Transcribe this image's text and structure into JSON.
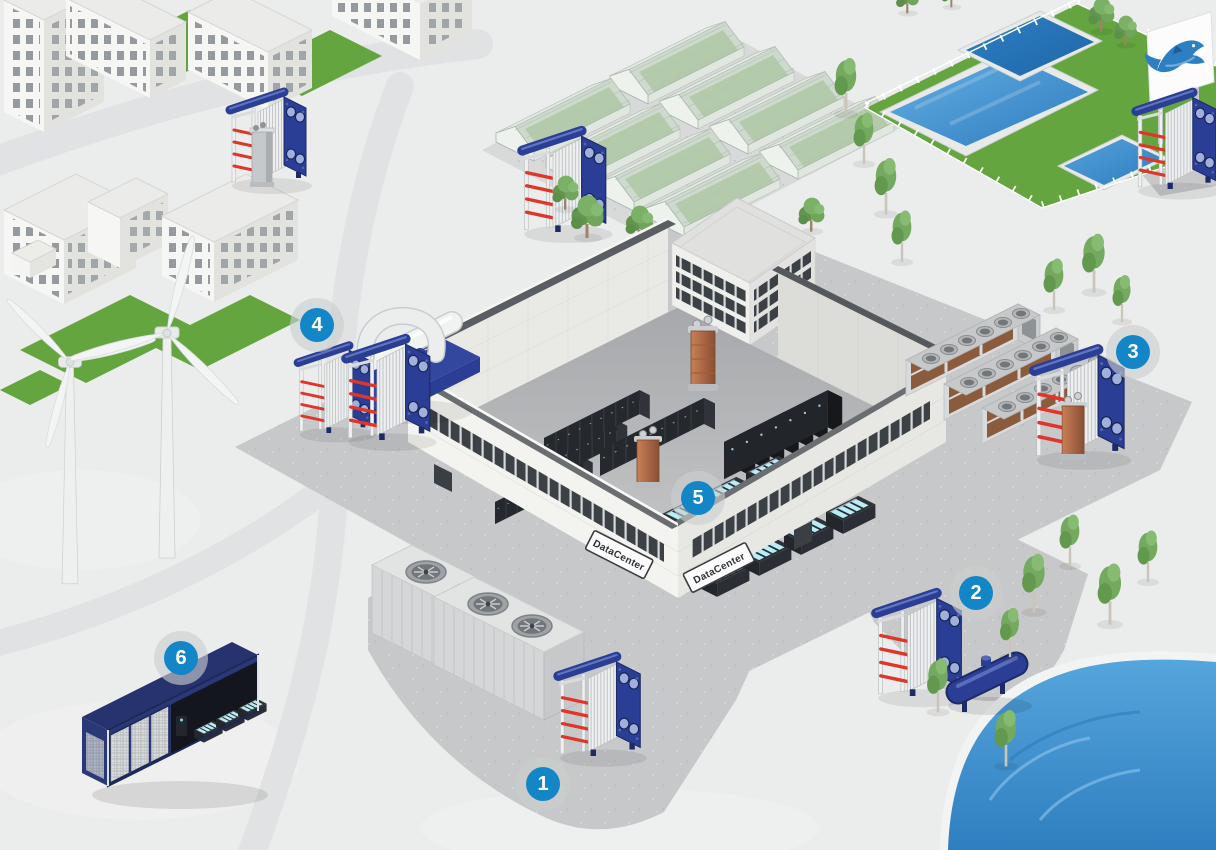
{
  "hotspots": [
    {
      "label": "1",
      "x": 543,
      "y": 784
    },
    {
      "label": "2",
      "x": 976,
      "y": 593
    },
    {
      "label": "3",
      "x": 1133,
      "y": 352
    },
    {
      "label": "4",
      "x": 317,
      "y": 325
    },
    {
      "label": "5",
      "x": 698,
      "y": 498
    },
    {
      "label": "6",
      "x": 181,
      "y": 658
    }
  ],
  "signs": [
    {
      "text": "DataCenter"
    },
    {
      "text": "DataCenter"
    }
  ],
  "icons": {
    "billboard_logo": "fish-icon"
  },
  "colors": {
    "hotspot_blue": "#1386c7",
    "hotspot_halo": "rgba(203,206,207,0.62)",
    "hx_frame_blue": "#2b3e96",
    "hx_pipe_red": "#e03528",
    "lake_blue": "#3f93cf",
    "pool_blue": "#4c9ed9",
    "lawn_green": "#64a53f",
    "container_navy": "#2a3878",
    "immersion_glow_cyan": "#b9ecf4",
    "pavement_gray": "#c7c8c9",
    "ground_snow": "#ebecec",
    "copper": "#b06a48"
  }
}
